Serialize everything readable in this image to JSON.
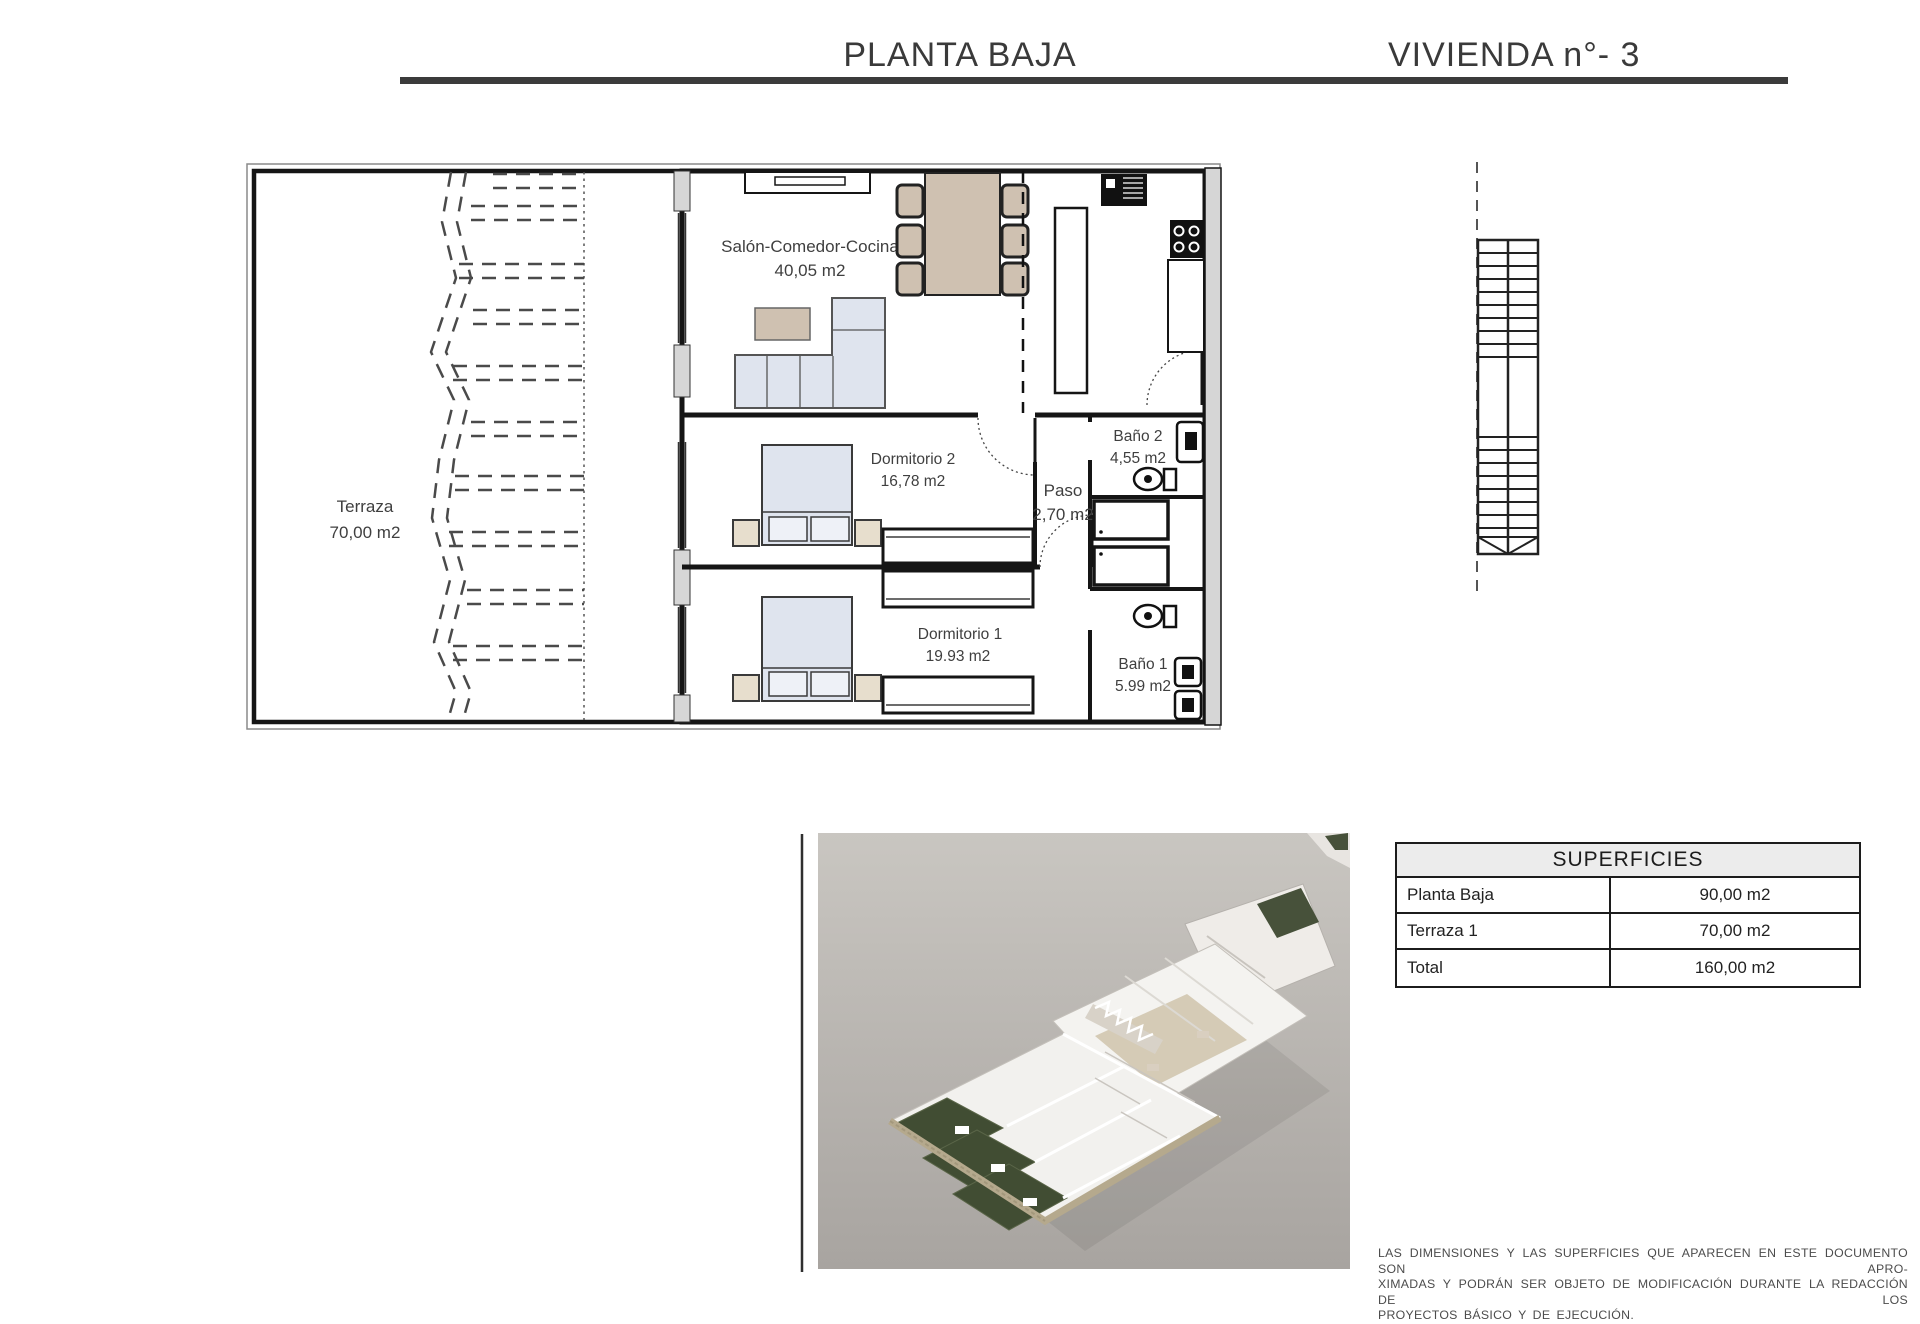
{
  "header": {
    "title_left": "PLANTA BAJA",
    "title_right": "VIVIENDA n°- 3"
  },
  "plan": {
    "salon": {
      "name": "Salón-Comedor-Cocina",
      "area": "40,05 m2"
    },
    "terraza": {
      "name": "Terraza",
      "area": "70,00 m2"
    },
    "dormitorio2": {
      "name": "Dormitorio 2",
      "area": "16,78 m2"
    },
    "paso": {
      "name": "Paso",
      "area": "2,70 m2"
    },
    "bano2": {
      "name": "Baño 2",
      "area": "4,55 m2"
    },
    "dormitorio1": {
      "name": "Dormitorio 1",
      "area": "19.93 m2"
    },
    "bano1": {
      "name": "Baño 1",
      "area": "5.99 m2"
    }
  },
  "superficies": {
    "title": "SUPERFICIES",
    "rows": [
      {
        "label": "Planta Baja",
        "value": "90,00 m2"
      },
      {
        "label": "Terraza 1",
        "value": "70,00 m2"
      },
      {
        "label": "Total",
        "value": "160,00 m2"
      }
    ]
  },
  "disclaimer": {
    "line1": "LAS DIMENSIONES Y LAS SUPERFICIES QUE APARECEN EN ESTE DOCUMENTO SON APRO-",
    "line2": "XIMADAS Y PODRÁN SER OBJETO DE MODIFICACIÓN DURANTE LA REDACCIÓN DE LOS",
    "line3": "PROYECTOS BÁSICO Y DE EJECUCIÓN."
  },
  "colors": {
    "accent_dark": "#3b3b3b",
    "wall": "#151515",
    "furniture_tan": "#cfc1b1",
    "bed_blue": "#dfe4ee",
    "nightstand_beige": "#e7decd",
    "gray_wall_band": "#d6d6d6",
    "photo_bg": "#bcb8b3",
    "garden_green": "#414d33",
    "sand_wall": "#b5a98d"
  }
}
